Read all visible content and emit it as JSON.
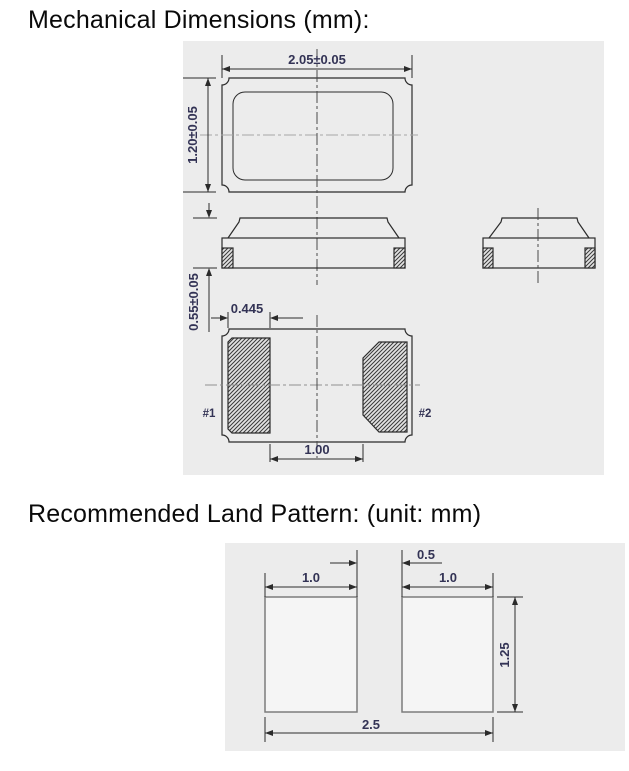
{
  "headings": {
    "mechanical": "Mechanical Dimensions (mm):",
    "land_pattern": "Recommended Land Pattern: (unit: mm)"
  },
  "mechanical": {
    "dim_body_width": "2.05±0.05",
    "dim_body_height": "1.20±0.05",
    "dim_thickness": "0.55±0.05",
    "dim_pad_width": "0.445",
    "dim_pad_pitch": "1.00",
    "pad1_label": "#1",
    "pad2_label": "#2"
  },
  "land_pattern": {
    "dim_gap": "0.5",
    "dim_pad_left_width": "1.0",
    "dim_pad_right_width": "1.0",
    "dim_pad_height": "1.25",
    "dim_total_width": "2.5"
  },
  "colors": {
    "drawing_background": "#ececec",
    "outline": "#2b2b2b",
    "dimension_text": "#333355",
    "centerline": "#999999",
    "land_pad_fill": "#f5f5f5",
    "land_pad_border": "#7d7d7d"
  }
}
